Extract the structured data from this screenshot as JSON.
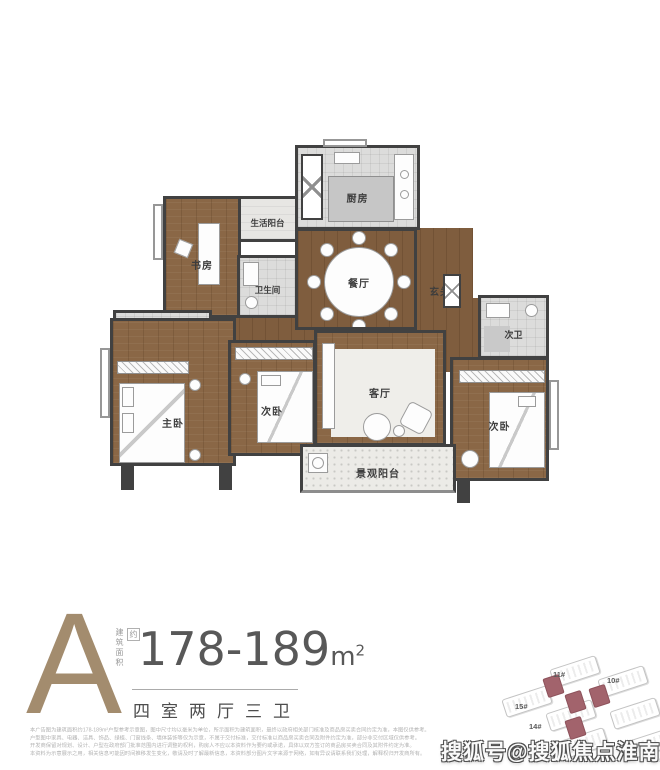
{
  "floor_plan": {
    "rooms": [
      {
        "id": "kitchen",
        "label": "厨房"
      },
      {
        "id": "service-balcony",
        "label": "生活阳台"
      },
      {
        "id": "study",
        "label": "书房"
      },
      {
        "id": "bathroom",
        "label": "卫生间"
      },
      {
        "id": "dining",
        "label": "餐厅"
      },
      {
        "id": "foyer",
        "label": "玄关"
      },
      {
        "id": "master-bath",
        "label": "主卫"
      },
      {
        "id": "master-bedroom",
        "label": "主卧"
      },
      {
        "id": "bedroom-2",
        "label": "次卧"
      },
      {
        "id": "living",
        "label": "客厅"
      },
      {
        "id": "bath-2",
        "label": "次卫"
      },
      {
        "id": "bedroom-3",
        "label": "次卧"
      },
      {
        "id": "view-balcony",
        "label": "景观阳台"
      }
    ]
  },
  "unit_info": {
    "type_letter": "A",
    "area_label_vertical": "建筑面积",
    "area_approx_badge": "约",
    "area_value": "178-189",
    "area_unit": "m",
    "area_unit_sup": "2",
    "layout_text": "四室两厅三卫"
  },
  "site_plan": {
    "building_labels": [
      "11#",
      "10#",
      "15#",
      "14#"
    ]
  },
  "disclaimer_lines": [
    "本广告图为建筑面积约178-189m²户型参考示意图，图中尺寸均以毫米为单位，所示面积为建筑面积，最终以政府相关部门核准及商品房买卖合同约定为准，本图仅供参考。",
    "户型图中家具、电器、洁具、饰品、绿植、门窗线条、墙体装饰等仅为示意，不属于交付标准，交付标准以商品房买卖合同及附件约定为准，部分非交付区域仅供参考。",
    "开发商保留对规划、设计、户型在政府部门批准范围内进行调整的权利，购房人不应以本资料作为要约或承诺，具体以双方签订的商品房买卖合同及其附件约定为准。",
    "本资料为示意展示之用，相关信息可能因时间推移发生变化，敬请及时了解最新信息，本资料部分图片文字来源于网络，如有异议请联系我们处理，解释权归开发商所有。"
  ],
  "watermark": "搜狐号@搜狐焦点淮南店",
  "colors": {
    "accent_tan": "#a38c6e",
    "wall": "#414141",
    "wood_floor": "#8a6746",
    "tile_floor": "#dcdcdb",
    "highlight_building": "#a2636c",
    "area_text": "#585858",
    "disclaimer_text": "#b3b3b3"
  }
}
